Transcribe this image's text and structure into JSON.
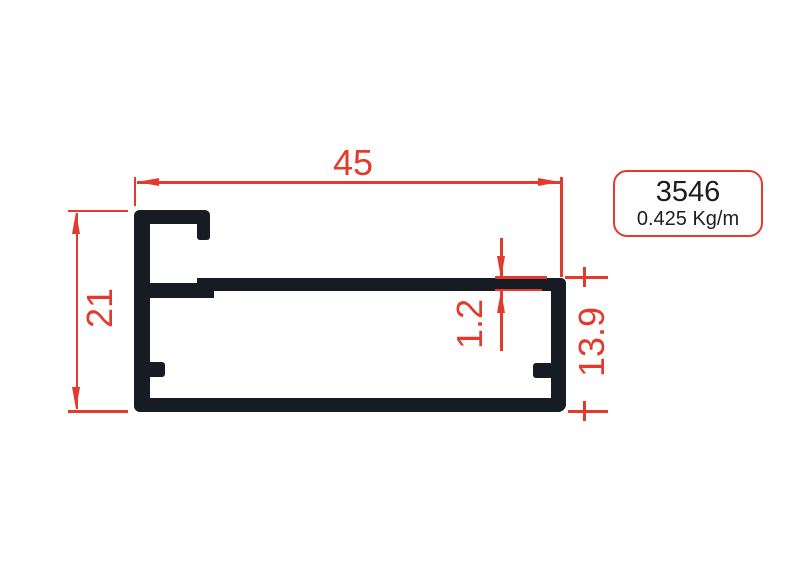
{
  "drawing": {
    "type": "aluminum-profile-cross-section",
    "colors": {
      "accent": "#e23a2c",
      "profile": "#171b23",
      "label_text": "#1d1d1d",
      "background": "#ffffff"
    },
    "dimensions": {
      "width_top": "45",
      "height_left": "21",
      "thickness": "1.2",
      "height_right": "13.9"
    },
    "label": {
      "profile_number": "3546",
      "weight": "0.425 Kg/m"
    }
  }
}
